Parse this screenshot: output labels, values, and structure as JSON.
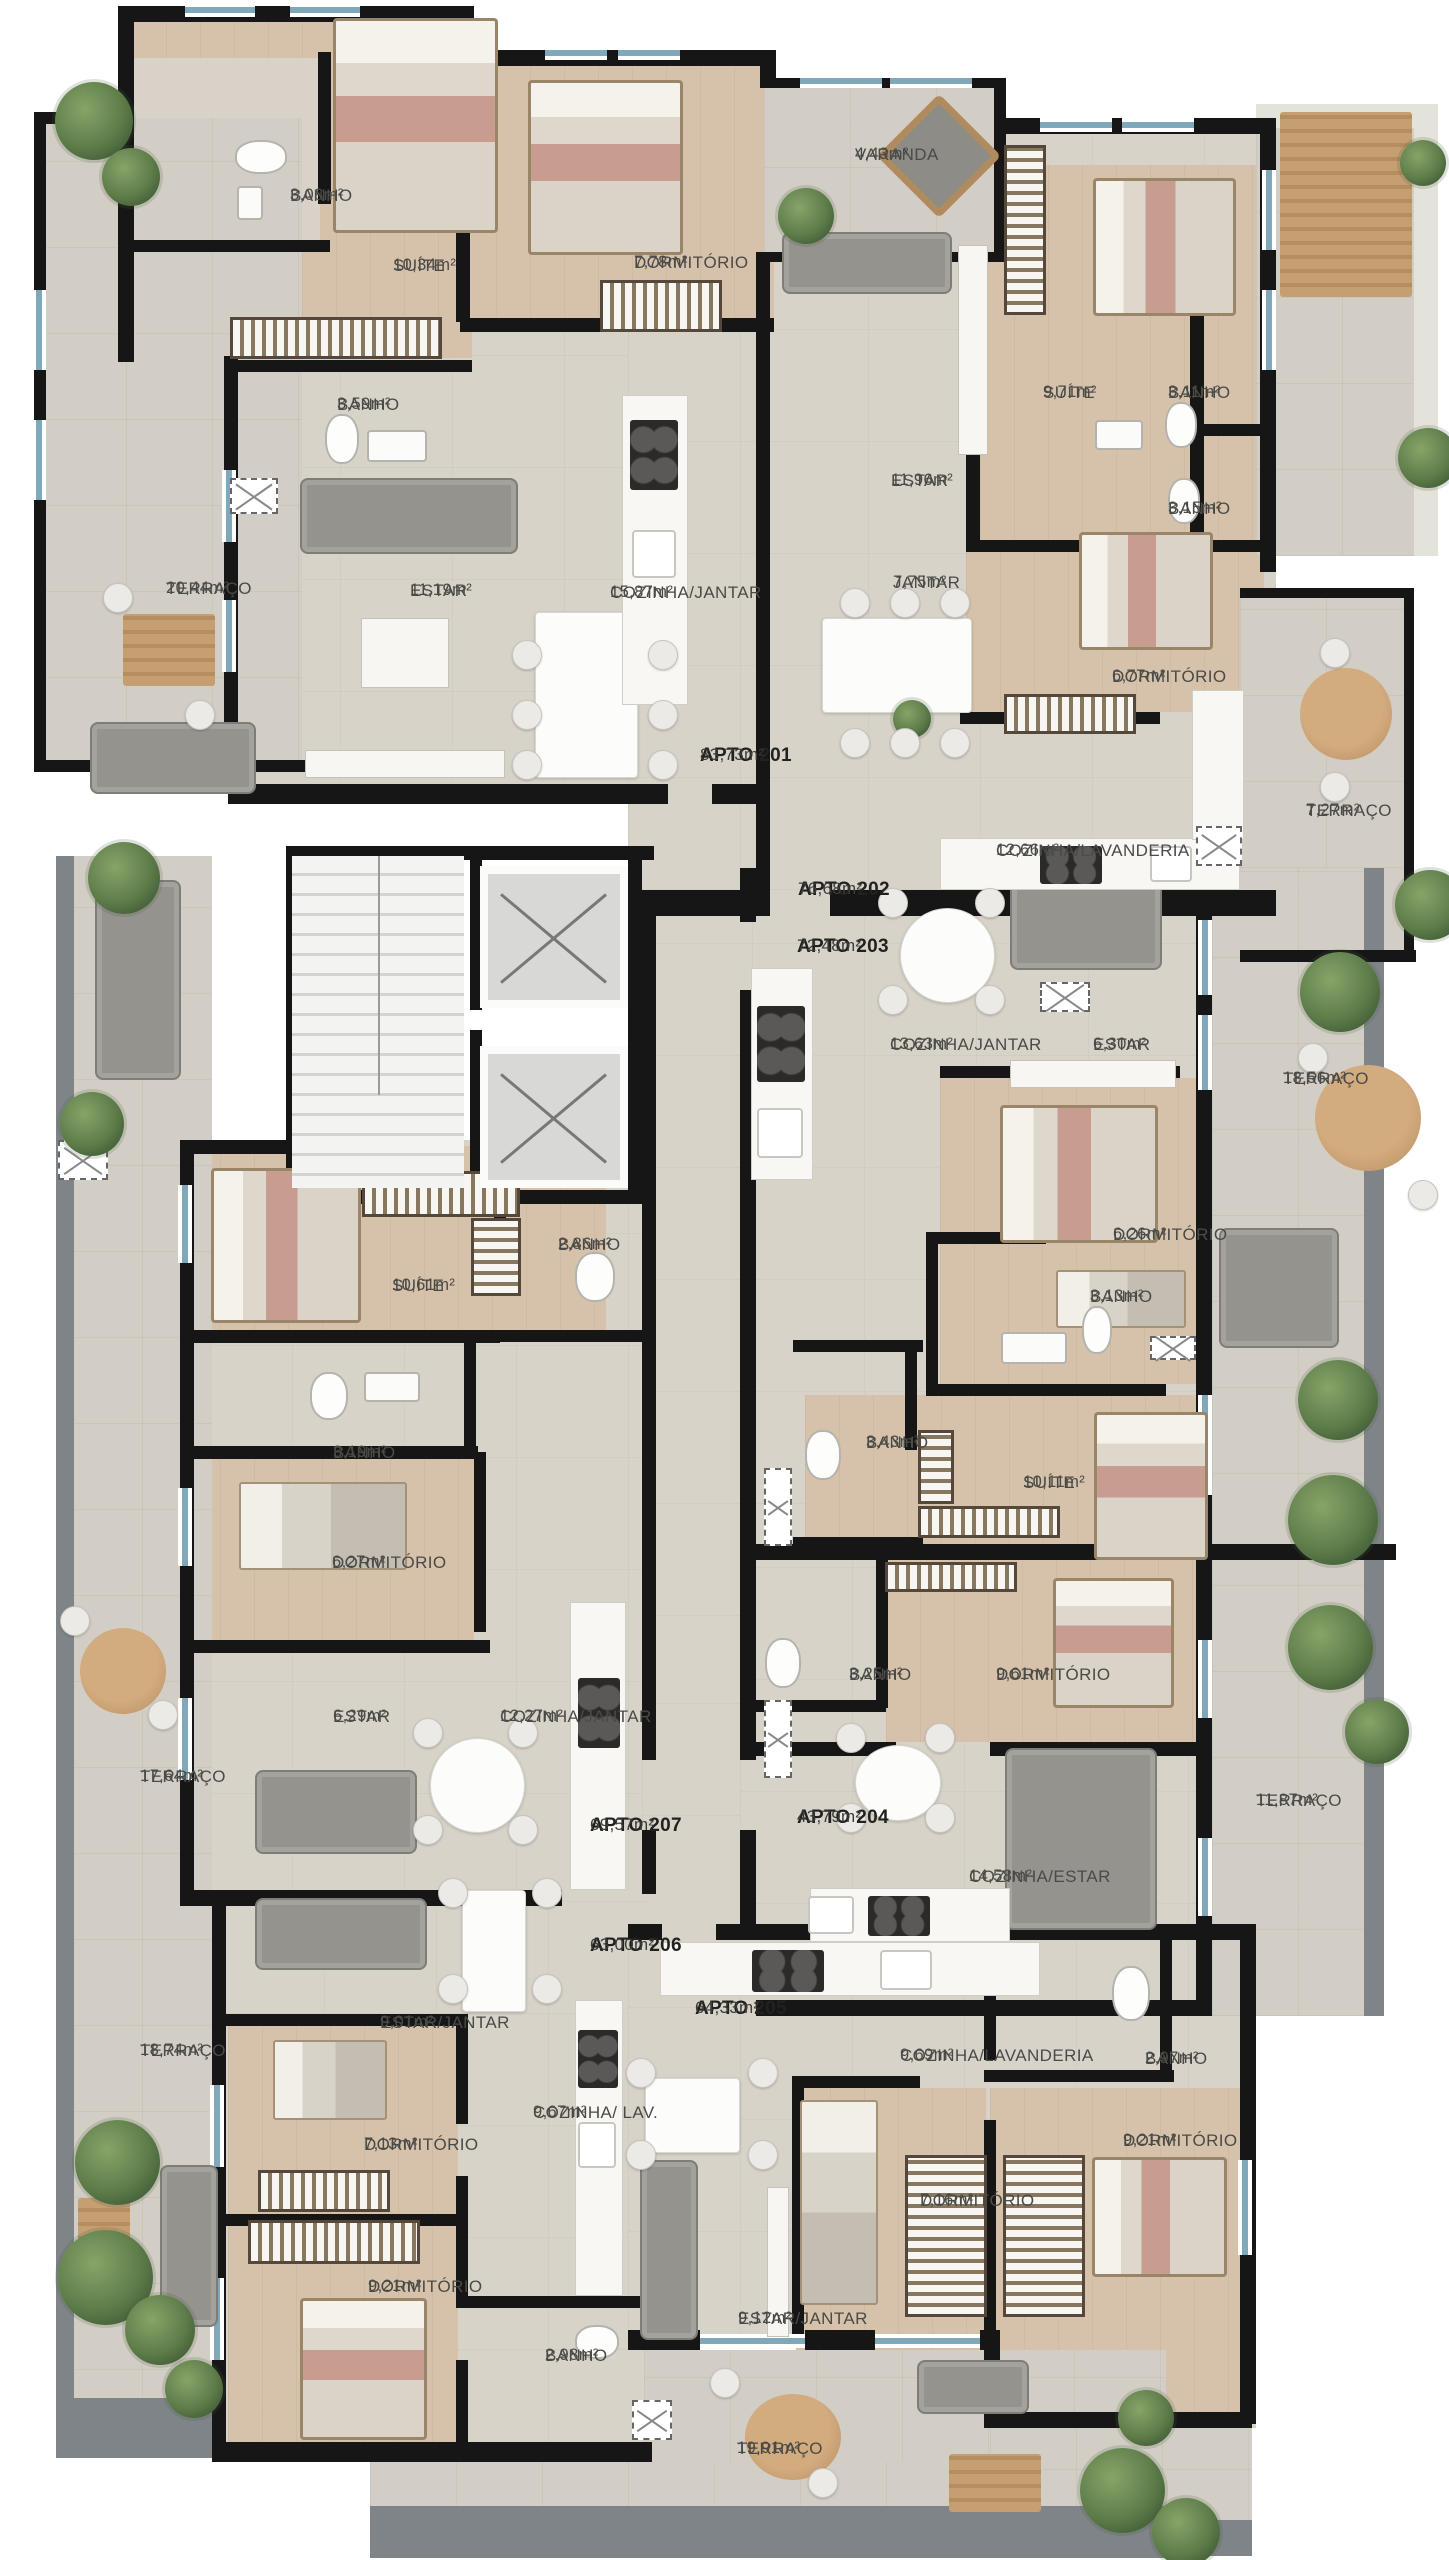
{
  "diagram": {
    "kind": "residential floor plan (pavement with 7 apartments)",
    "unit_suffix": "m²"
  },
  "colors": {
    "wall": "#161616",
    "floor": "#d8d3c9",
    "wood_floor": "#d6c2aa",
    "terrace": "#d2cec5",
    "window_accent": "#7fa9ba",
    "label": "#4a4a47",
    "plant": "#5d7c49"
  },
  "apartments": [
    {
      "name": "APTO 201",
      "area": "83,73m²",
      "x": 700,
      "y": 744
    },
    {
      "name": "APTO 202",
      "area": "76,68m²",
      "x": 798,
      "y": 878
    },
    {
      "name": "APTO 203",
      "area": "72,48m²",
      "x": 797,
      "y": 935
    },
    {
      "name": "APTO 204",
      "area": "43,79m²",
      "x": 797,
      "y": 1806
    },
    {
      "name": "APTO 205",
      "area": "64,33m²",
      "x": 695,
      "y": 1997
    },
    {
      "name": "APTO 206",
      "area": "63,00m²",
      "x": 590,
      "y": 1934
    },
    {
      "name": "APTO 207",
      "area": "69,57m²",
      "x": 590,
      "y": 1814
    }
  ],
  "rooms": [
    {
      "name": "BANHO",
      "area": "3,08m²",
      "x": 290,
      "y": 185
    },
    {
      "name": "SUÍTE",
      "area": "10,34m²",
      "x": 393,
      "y": 255
    },
    {
      "name": "DORMITÓRIO",
      "area": "7,78m²",
      "x": 634,
      "y": 252
    },
    {
      "name": "VARANDA",
      "area": "4,43m²",
      "x": 855,
      "y": 144
    },
    {
      "name": "SUÍTE",
      "area": "9,71m²",
      "x": 1043,
      "y": 382
    },
    {
      "name": "BANHO",
      "area": "3,11m²",
      "x": 1168,
      "y": 382
    },
    {
      "name": "BANHO",
      "area": "3,15m²",
      "x": 1168,
      "y": 498
    },
    {
      "name": "ESTAR",
      "area": "11,96m²",
      "x": 891,
      "y": 470
    },
    {
      "name": "BANHO",
      "area": "3,59m²",
      "x": 337,
      "y": 394
    },
    {
      "name": "TERRAÇO",
      "area": "20,44m²",
      "x": 166,
      "y": 578
    },
    {
      "name": "ESTAR",
      "area": "11,19m²",
      "x": 410,
      "y": 580
    },
    {
      "name": "COZINHA/JANTAR",
      "area": "15,87m²",
      "x": 610,
      "y": 582
    },
    {
      "name": "JANTAR",
      "area": "7,75m²",
      "x": 893,
      "y": 572
    },
    {
      "name": "DORMITÓRIO",
      "area": "6,77m²",
      "x": 1112,
      "y": 666
    },
    {
      "name": "COZINHA/LAVANDERIA",
      "area": "12,66m²",
      "x": 996,
      "y": 840
    },
    {
      "name": "TERRAÇO",
      "area": "7,27m²",
      "x": 1306,
      "y": 800
    },
    {
      "name": "COZINHA/JANTAR",
      "area": "13,63m²",
      "x": 890,
      "y": 1034
    },
    {
      "name": "ESTAR",
      "area": "6,30m²",
      "x": 1093,
      "y": 1034
    },
    {
      "name": "TERRAÇO",
      "area": "18,56m²",
      "x": 1283,
      "y": 1068
    },
    {
      "name": "DORMITÓRIO",
      "area": "6,26m²",
      "x": 1113,
      "y": 1224
    },
    {
      "name": "BANHO",
      "area": "2,86m²",
      "x": 558,
      "y": 1234
    },
    {
      "name": "SUÍTE",
      "area": "10,61m²",
      "x": 392,
      "y": 1275
    },
    {
      "name": "BANHO",
      "area": "3,13m²",
      "x": 1090,
      "y": 1286
    },
    {
      "name": "BANHO",
      "area": "3,19m²",
      "x": 333,
      "y": 1442
    },
    {
      "name": "BANHO",
      "area": "3,43m²",
      "x": 866,
      "y": 1432
    },
    {
      "name": "SUÍTE",
      "area": "10,11m²",
      "x": 1023,
      "y": 1472
    },
    {
      "name": "DORMITÓRIO",
      "area": "6,27m²",
      "x": 332,
      "y": 1552
    },
    {
      "name": "ESTAR",
      "area": "6,29m²",
      "x": 333,
      "y": 1706
    },
    {
      "name": "COZINHA/JANTAR",
      "area": "12,27m²",
      "x": 500,
      "y": 1706
    },
    {
      "name": "BANHO",
      "area": "3,25m²",
      "x": 849,
      "y": 1664
    },
    {
      "name": "DORMITÓRIO",
      "area": "9,61m²",
      "x": 996,
      "y": 1664
    },
    {
      "name": "TERRAÇO",
      "area": "17,64m²",
      "x": 140,
      "y": 1766
    },
    {
      "name": "COZINHA/ESTAR",
      "area": "14,58m²",
      "x": 969,
      "y": 1866
    },
    {
      "name": "TERRAÇO",
      "area": "11,87m²",
      "x": 1256,
      "y": 1790
    },
    {
      "name": "ESTAR/JANTAR",
      "area": "9,01m²",
      "x": 380,
      "y": 2012
    },
    {
      "name": "TERRAÇO",
      "area": "18,74m²",
      "x": 140,
      "y": 2040
    },
    {
      "name": "COZINHA/LAVANDERIA",
      "area": "9,69m²",
      "x": 900,
      "y": 2045
    },
    {
      "name": "BANHO",
      "area": "2,97m²",
      "x": 1145,
      "y": 2048
    },
    {
      "name": "COZINHA/ LAV.",
      "area": "9,67m²",
      "x": 533,
      "y": 2102
    },
    {
      "name": "DORMITÓRIO",
      "area": "7,13m²",
      "x": 364,
      "y": 2134
    },
    {
      "name": "DORMITÓRIO",
      "area": "9,21m²",
      "x": 1123,
      "y": 2130
    },
    {
      "name": "DORMITÓRIO",
      "area": "7,16m²",
      "x": 920,
      "y": 2190
    },
    {
      "name": "ESTAR/JANTAR",
      "area": "9,12m²",
      "x": 738,
      "y": 2308
    },
    {
      "name": "DORMITÓRIO",
      "area": "9,21m²",
      "x": 368,
      "y": 2276
    },
    {
      "name": "BANHO",
      "area": "2,98m²",
      "x": 545,
      "y": 2345
    },
    {
      "name": "TERRAÇO",
      "area": "19,91m²",
      "x": 737,
      "y": 2438
    }
  ]
}
